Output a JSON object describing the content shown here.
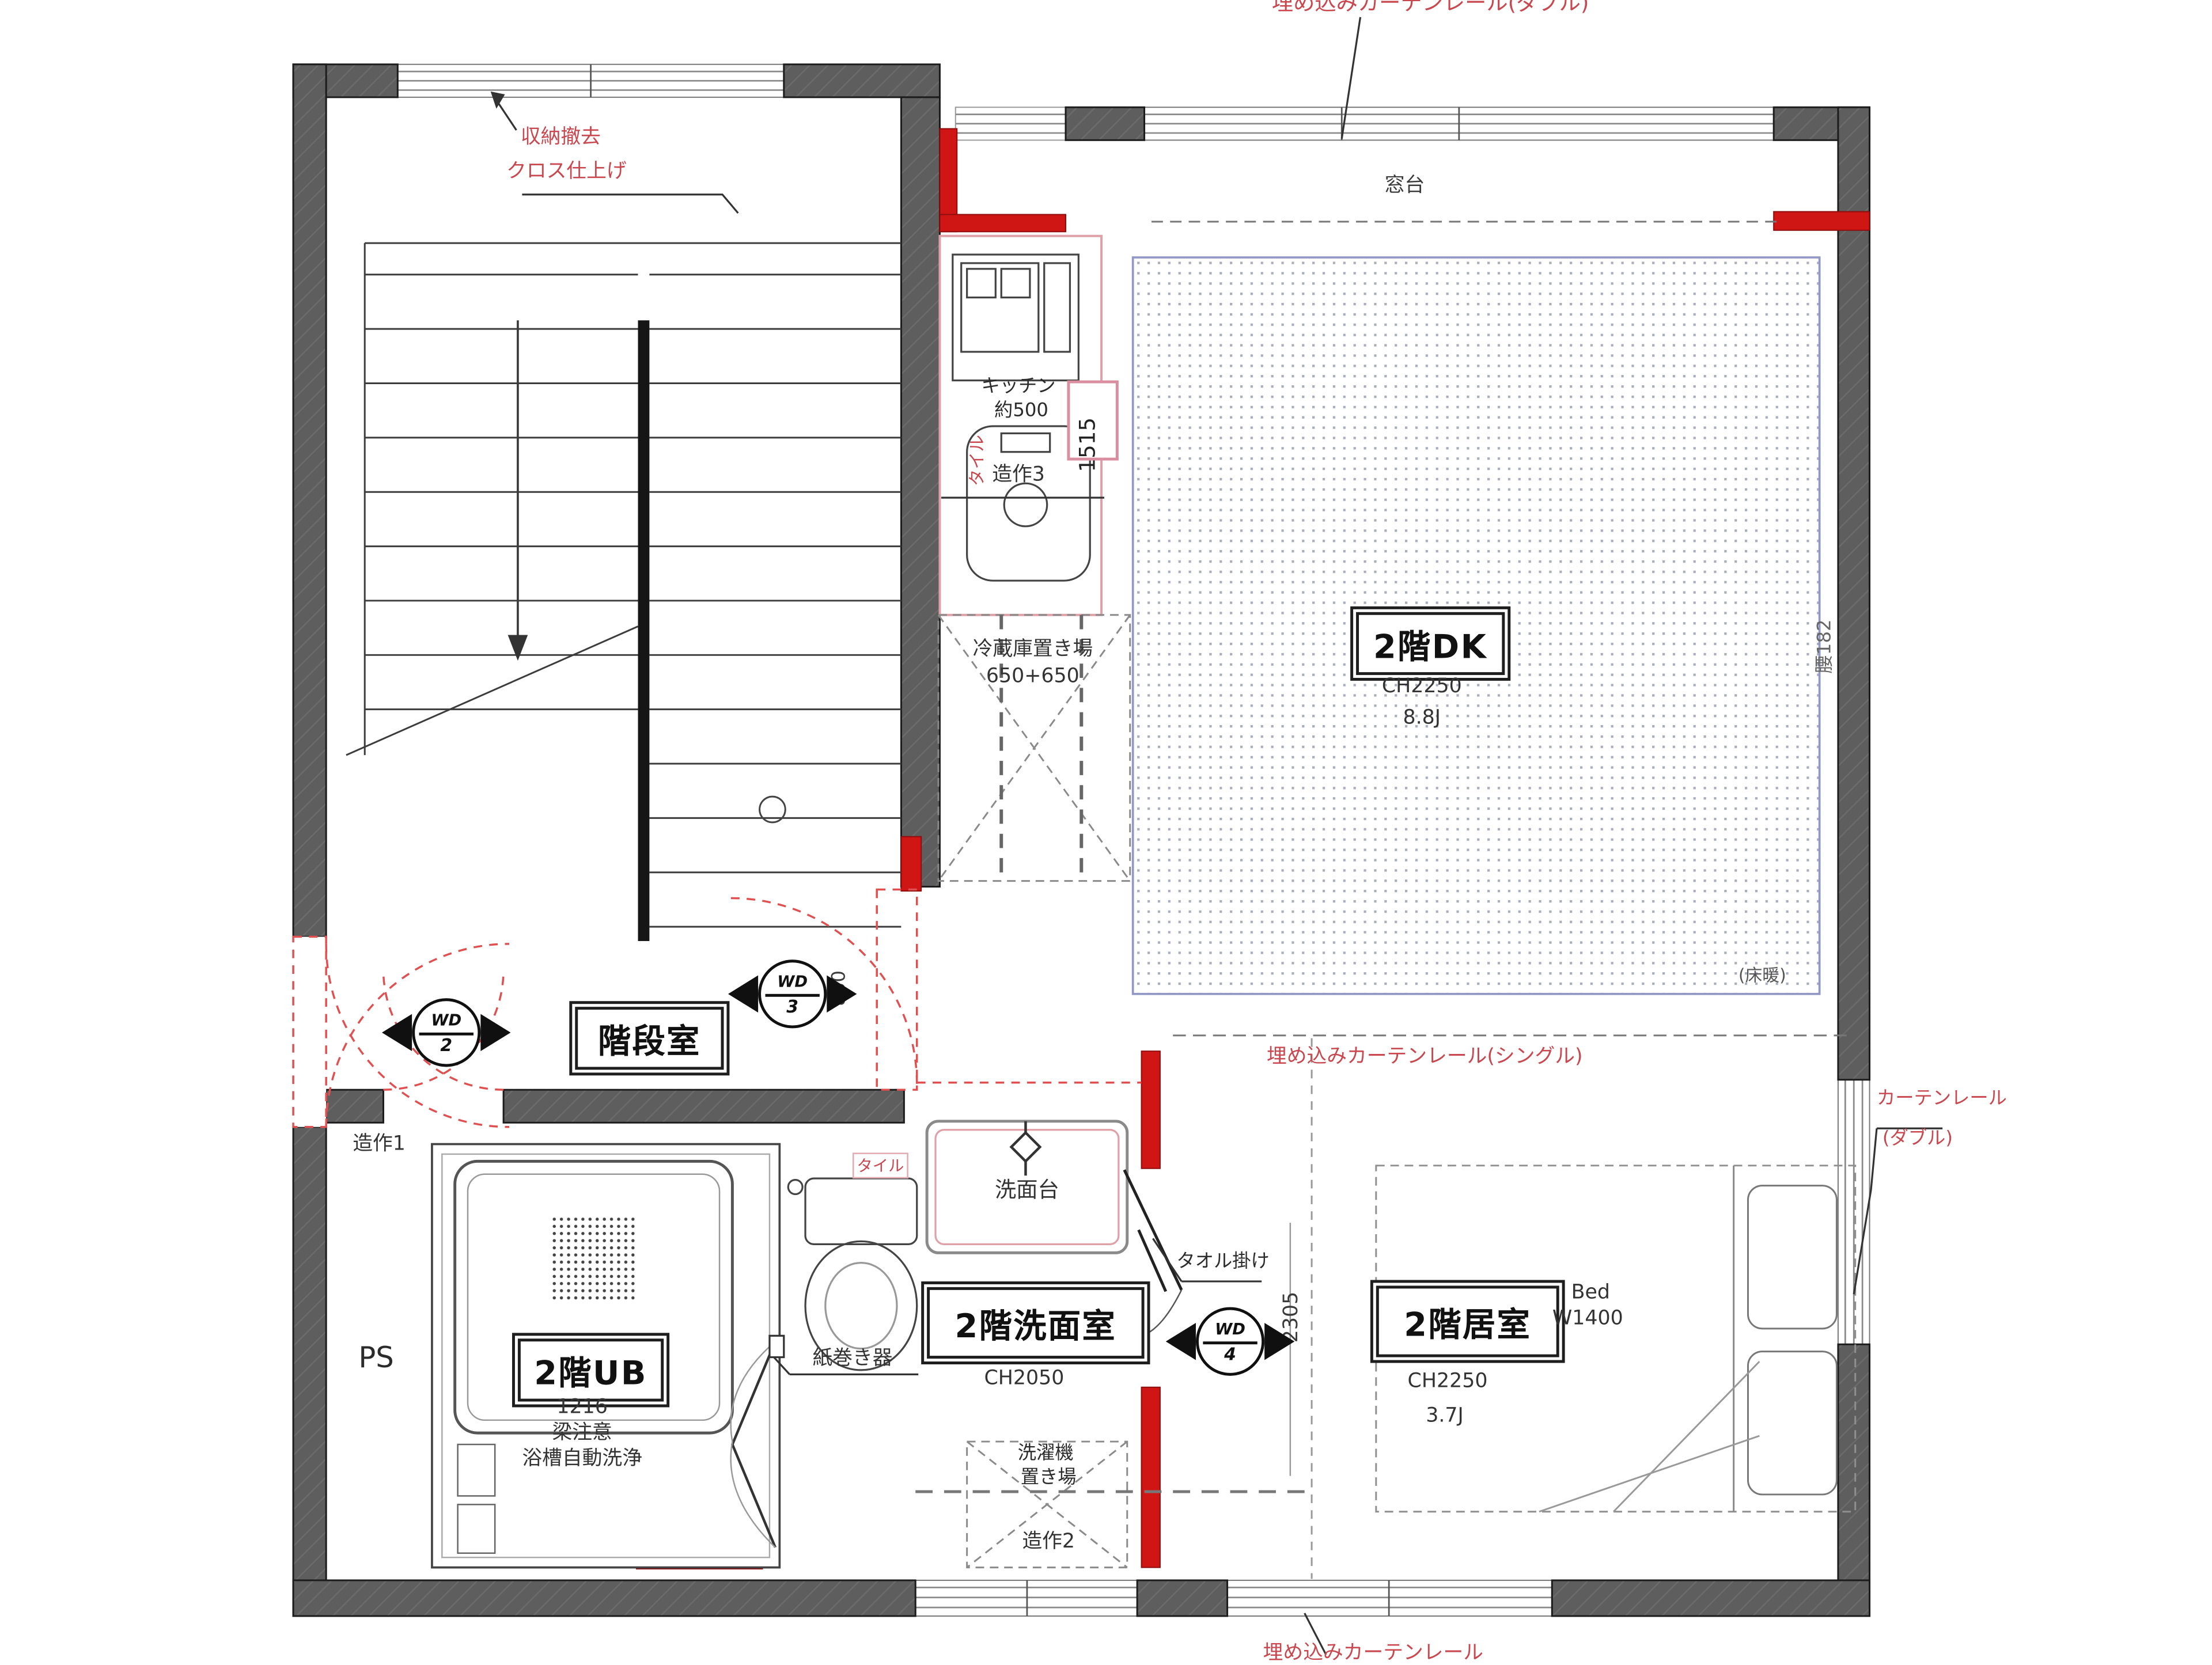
{
  "rooms": {
    "stairwell": {
      "label": "階段室"
    },
    "dk": {
      "label": "2階DK",
      "ceiling": "CH2250",
      "area": "8.8J",
      "floor_heating": "(床暖)"
    },
    "washroom": {
      "label": "2階洗面室",
      "ceiling": "CH2050"
    },
    "bathroom": {
      "label": "2階UB",
      "size": "1216",
      "warning": "梁注意",
      "note": "浴槽自動洗浄"
    },
    "bedroom": {
      "label": "2階居室",
      "ceiling": "CH2250",
      "area": "3.7J",
      "bed_label": "Bed",
      "bed_width": "W1400"
    },
    "pipe_space": {
      "label": "PS"
    }
  },
  "doors": {
    "wd2": {
      "code": "WD",
      "number": "2"
    },
    "wd3": {
      "code": "WD",
      "number": "3"
    },
    "wd4": {
      "code": "WD",
      "number": "4"
    }
  },
  "dimensions": {
    "kitchen_counter": "1515",
    "opening_850": "850",
    "bedroom_2305": "2305",
    "sill_height": "腰182"
  },
  "annotations": {
    "storage_removal": "収納撤去",
    "cross_finish": "クロス仕上げ",
    "window_sill": "窓台",
    "kitchen": "キッチン",
    "kitchen_width": "約500",
    "fixture1": "造作1",
    "fixture2": "造作2",
    "fixture3": "造作3",
    "fridge_space": "冷蔵庫置き場",
    "fridge_size": "650+650",
    "curtain_rail_top": "埋め込みカーテンレール(ダブル)",
    "curtain_rail_single": "埋め込みカーテンレール(シングル)",
    "curtain_rail_right1": "カーテンレール",
    "curtain_rail_right2": "(ダブル)",
    "curtain_rail_bottom": "埋め込みカーテンレール",
    "tile_kitchen": "タイル",
    "tile_wash": "タイル",
    "washbasin": "洗面台",
    "towel_bar": "タオル掛け",
    "paper_holder": "紙巻き器",
    "washer1": "洗濯機",
    "washer2": "置き場"
  },
  "colors": {
    "wall": "#5e5e5e",
    "red_wall": "#d01515",
    "red_text": "#c9474e",
    "pink": "#dfa0a8",
    "blue_border": "#9298c5"
  }
}
